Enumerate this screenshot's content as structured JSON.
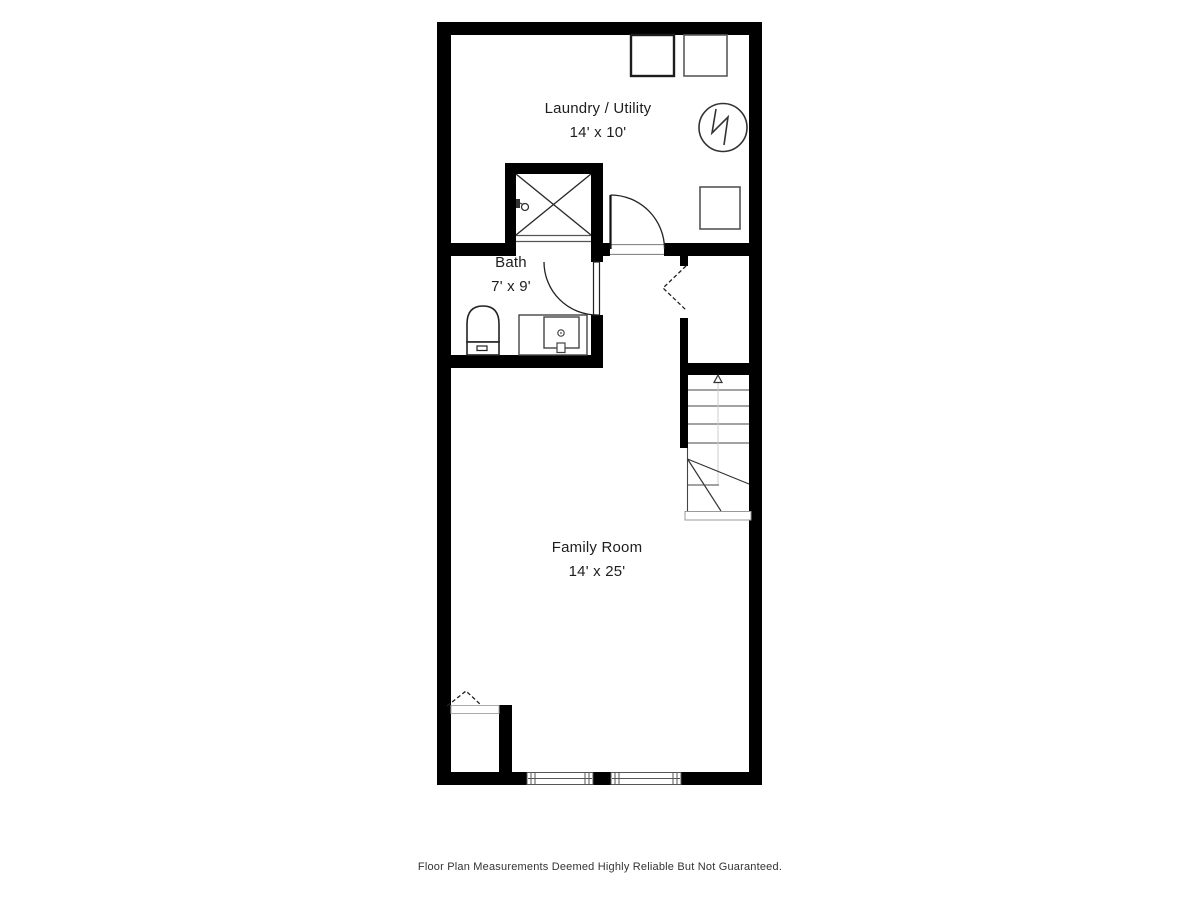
{
  "page": {
    "background": "#ffffff"
  },
  "plan": {
    "wall_color": "#000000",
    "fixture_line_color": "#3a3a3a",
    "rooms": [
      {
        "name": "Laundry / Utility",
        "dimensions": "14' x 10'"
      },
      {
        "name": "Bath",
        "dimensions": "7' x 9'"
      },
      {
        "name": "Family Room",
        "dimensions": "14' x 25'"
      }
    ],
    "fixtures": [
      "washer",
      "dryer",
      "water-heater",
      "furnace",
      "shower",
      "shower-head",
      "toilet",
      "vanity-sink",
      "laundry-door",
      "bath-door",
      "closet-bifold-door",
      "stairs",
      "stair-direction-arrow",
      "closet-under-stairs",
      "window",
      "window"
    ]
  },
  "footer": {
    "disclaimer": "Floor Plan Measurements Deemed Highly Reliable But Not Guaranteed."
  }
}
